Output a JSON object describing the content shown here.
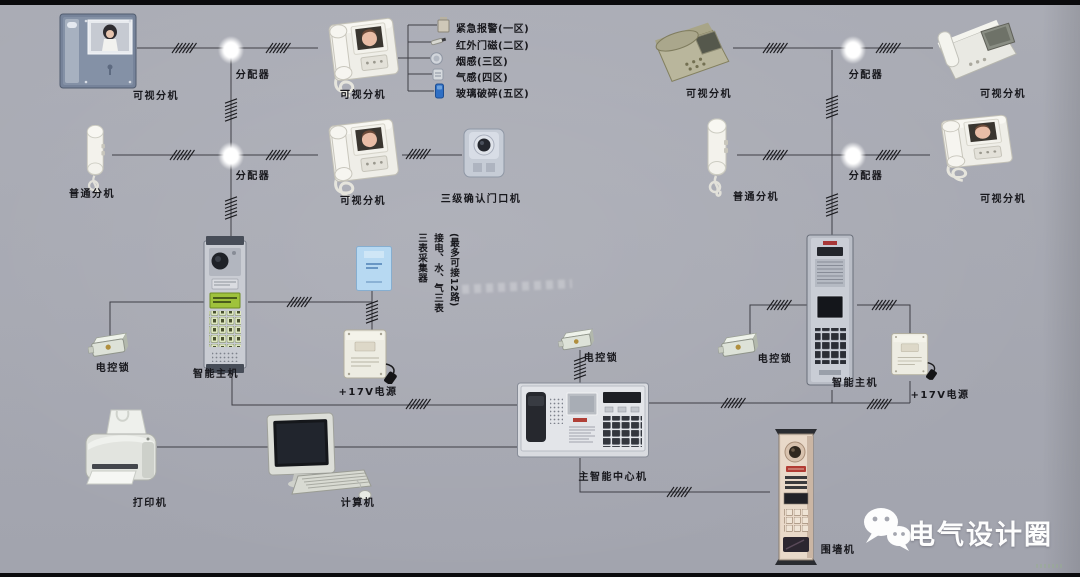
{
  "meta": {
    "bg_color": "#a8aab3",
    "line_color": "#3f3f46",
    "accent_blue": "#2f6fc4"
  },
  "sections": {
    "left": {
      "monitor": "可视分机",
      "distributor1": "分配器",
      "videophone1": "可视分机",
      "sensors": [
        {
          "icon": "emergency-alarm-icon",
          "label": "紧急报警(一区)"
        },
        {
          "icon": "infrared-door-contact-icon",
          "label": "红外门磁(二区)"
        },
        {
          "icon": "smoke-detector-icon",
          "label": "烟感(三区)"
        },
        {
          "icon": "gas-detector-icon",
          "label": "气感(四区)"
        },
        {
          "icon": "glass-break-icon",
          "label": "玻璃破碎(五区)"
        }
      ],
      "handset": "普通分机",
      "distributor2": "分配器",
      "videophone2": "可视分机",
      "door_station": "三级确认门口机"
    },
    "center": {
      "smart_host": "智能主机",
      "electric_lock": "电控锁",
      "meter_collector_note": [
        "(最多可接12路)",
        "接电、水、气三表",
        "三表采集器"
      ],
      "power_supply": "+17V电源",
      "printer": "打印机",
      "computer": "计算机",
      "main_console": "主智能中心机",
      "console_lock": "电控锁"
    },
    "right": {
      "videophone1": "可视分机",
      "distributor1": "分配器",
      "videophone2": "可视分机",
      "handset": "普通分机",
      "distributor2": "分配器",
      "videophone3": "可视分机",
      "electric_lock": "电控锁",
      "smart_host": "智能主机",
      "power_supply": "+17V电源",
      "perimeter_station": "围墙机"
    },
    "brand": {
      "icon": "wechat-icon",
      "name": "电气设计圈"
    }
  }
}
